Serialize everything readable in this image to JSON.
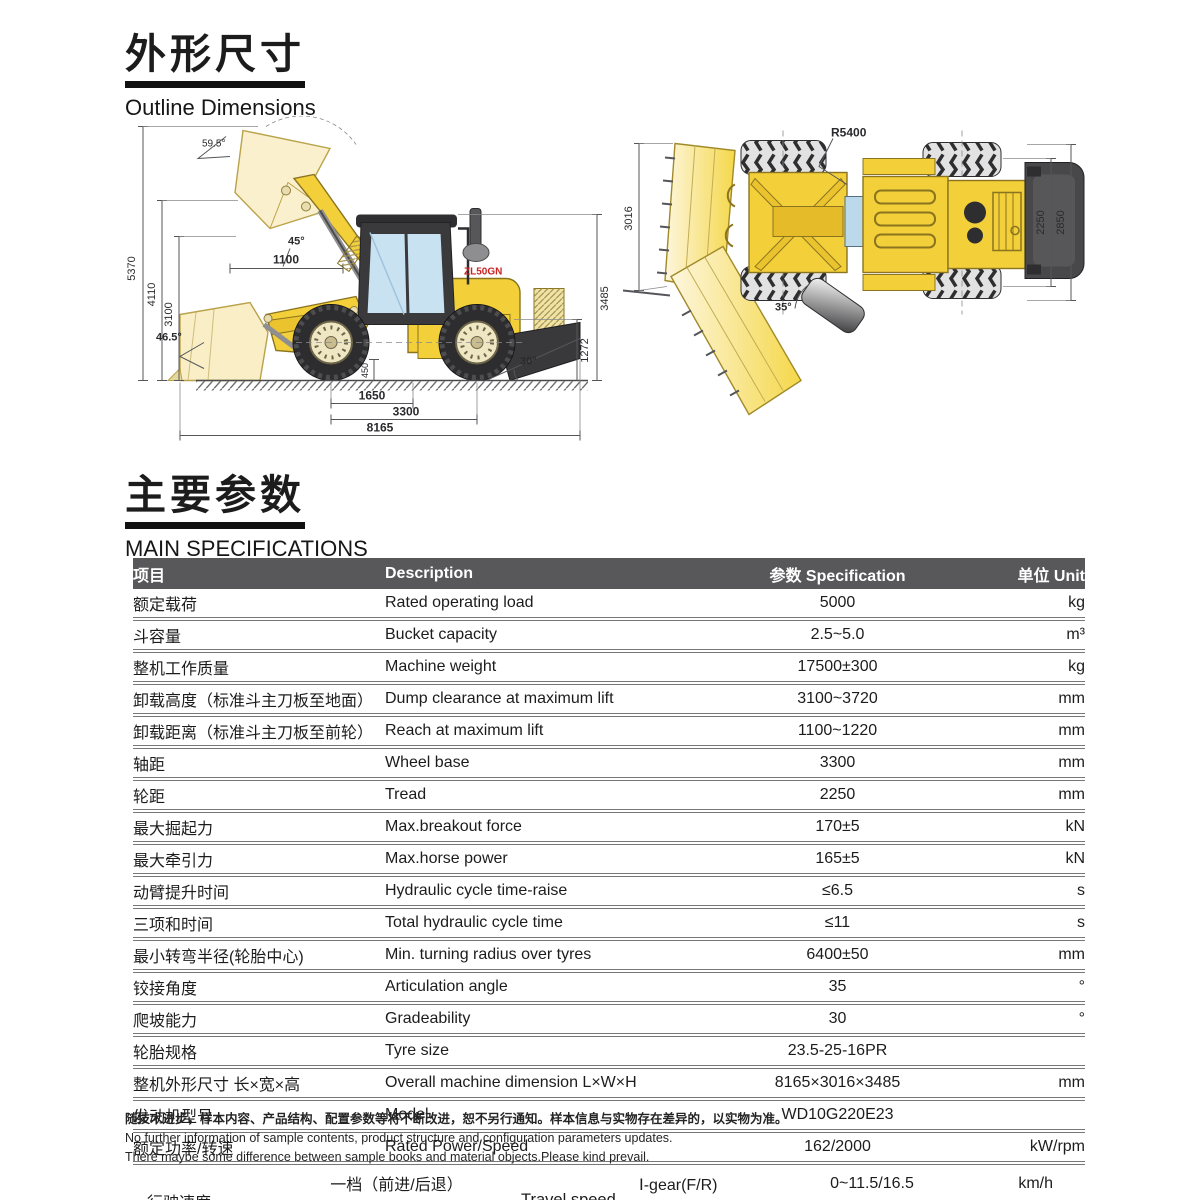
{
  "sections": {
    "outline": {
      "title_zh": "外形尺寸",
      "title_en": "Outline Dimensions"
    },
    "specs": {
      "title_zh": "主要参数",
      "title_en": "MAIN SPECIFICATIONS"
    }
  },
  "drawings": {
    "side": {
      "logo": "ZL50GN",
      "angle_top": "59.5°",
      "angle_dump": "45°",
      "dim_reach": "1100",
      "dim_h_total": "5370",
      "dim_h_hinge": "4110",
      "dim_h_dump": "3100",
      "angle_carry": "46.5°",
      "dim_h_machine": "3485",
      "dim_h_rear": "1272",
      "dim_clearance": "450",
      "angle_departure": "30°",
      "dim_front": "1650",
      "dim_wheelbase": "3300",
      "dim_length": "8165"
    },
    "top": {
      "dim_width": "3016",
      "radius": "R5400",
      "dim_tread": "2250",
      "dim_width_tyres": "2850",
      "angle_articulation": "35°"
    }
  },
  "table": {
    "headers": {
      "item": "项目",
      "description": "Description",
      "spec": "参数 Specification",
      "unit": "单位 Unit"
    },
    "rows": [
      {
        "item": "额定载荷",
        "desc": "Rated operating load",
        "spec": "5000",
        "unit": "kg"
      },
      {
        "item": "斗容量",
        "desc": "Bucket capacity",
        "spec": "2.5~5.0",
        "unit": "m³"
      },
      {
        "item": "整机工作质量",
        "desc": "Machine weight",
        "spec": "17500±300",
        "unit": "kg"
      },
      {
        "item": "卸载高度（标准斗主刀板至地面）",
        "desc": "Dump clearance at maximum lift",
        "spec": "3100~3720",
        "unit": "mm"
      },
      {
        "item": "卸载距离（标准斗主刀板至前轮）",
        "desc": "Reach at maximum lift",
        "spec": "1100~1220",
        "unit": "mm"
      },
      {
        "item": "轴距",
        "desc": "Wheel base",
        "spec": "3300",
        "unit": "mm"
      },
      {
        "item": "轮距",
        "desc": "Tread",
        "spec": "2250",
        "unit": "mm"
      },
      {
        "item": "最大掘起力",
        "desc": "Max.breakout force",
        "spec": "170±5",
        "unit": "kN"
      },
      {
        "item": "最大牵引力",
        "desc": "Max.horse power",
        "spec": "165±5",
        "unit": "kN"
      },
      {
        "item": "动臂提升时间",
        "desc": "Hydraulic cycle time-raise",
        "spec": "≤6.5",
        "unit": "s"
      },
      {
        "item": "三项和时间",
        "desc": "Total hydraulic cycle time",
        "spec": "≤11",
        "unit": "s"
      },
      {
        "item": "最小转弯半径(轮胎中心)",
        "desc": "Min. turning radius over tyres",
        "spec": "6400±50",
        "unit": "mm"
      },
      {
        "item": "铰接角度",
        "desc": "Articulation angle",
        "spec": "35",
        "unit": "°"
      },
      {
        "item": "爬坡能力",
        "desc": "Gradeability",
        "spec": "30",
        "unit": "°"
      },
      {
        "item": "轮胎规格",
        "desc": "Tyre size",
        "spec": "23.5-25-16PR",
        "unit": ""
      },
      {
        "item": "整机外形尺寸 长×宽×高",
        "desc": "Overall machine dimension L×W×H",
        "spec": "8165×3016×3485",
        "unit": "mm"
      },
      {
        "item": "发动机型号",
        "desc": "Model",
        "spec": "WD10G220E23",
        "unit": ""
      },
      {
        "item": "额定功率/转速",
        "desc": "Rated Power/Speed",
        "spec": "162/2000",
        "unit": "kW/rpm"
      }
    ],
    "travel": {
      "item": "行驶速度",
      "gear1_zh": "一档（前进/后退）",
      "gear2_zh": "二档（前进）",
      "desc": "Travel speed",
      "gear1_en": "Ⅰ-gear(F/R)",
      "gear2_en": "Ⅱ-gear(F)",
      "spec1": "0~11.5/16.5",
      "spec2": "0~38",
      "unit1": "km/h",
      "unit2": "km/h"
    }
  },
  "footer": {
    "line_zh": "随技术进步，样本内容、产品结构、配置参数等将不断改进，恕不另行通知。样本信息与实物存在差异的，以实物为准。",
    "line_en1": "No further information of sample contents, product structure and configuration parameters updates.",
    "line_en2": "There maybe some difference between sample books and material objects.Please kind prevail."
  },
  "colors": {
    "header_bg": "#58585a",
    "body_yellow": "#f3cf39",
    "pale_yellow": "#f9eec6",
    "cab_dark": "#3a3a3c",
    "window_blue": "#c9e2f2",
    "logo_red": "#cc2222"
  }
}
